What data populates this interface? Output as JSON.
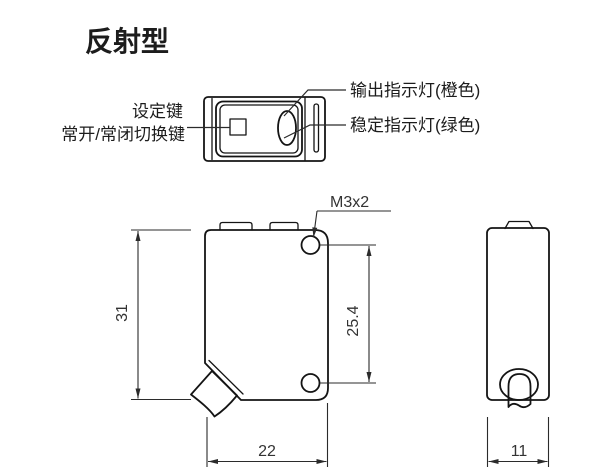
{
  "title": "反射型",
  "colors": {
    "background": "#ffffff",
    "line": "#141414",
    "dimension_line": "#2b2b2b",
    "text": "#1c1c1c"
  },
  "top_view": {
    "callouts": {
      "output_indicator": "输出指示灯(橙色)",
      "stability_indicator": "稳定指示灯(绿色)",
      "setting_key": "设定键",
      "no_nc_switch_key": "常开/常闭切换键"
    }
  },
  "front_view": {
    "thread_label": "M3x2",
    "dim_height": "31",
    "dim_hole_pitch": "25.4",
    "dim_width": "22"
  },
  "side_view": {
    "dim_depth": "11"
  }
}
